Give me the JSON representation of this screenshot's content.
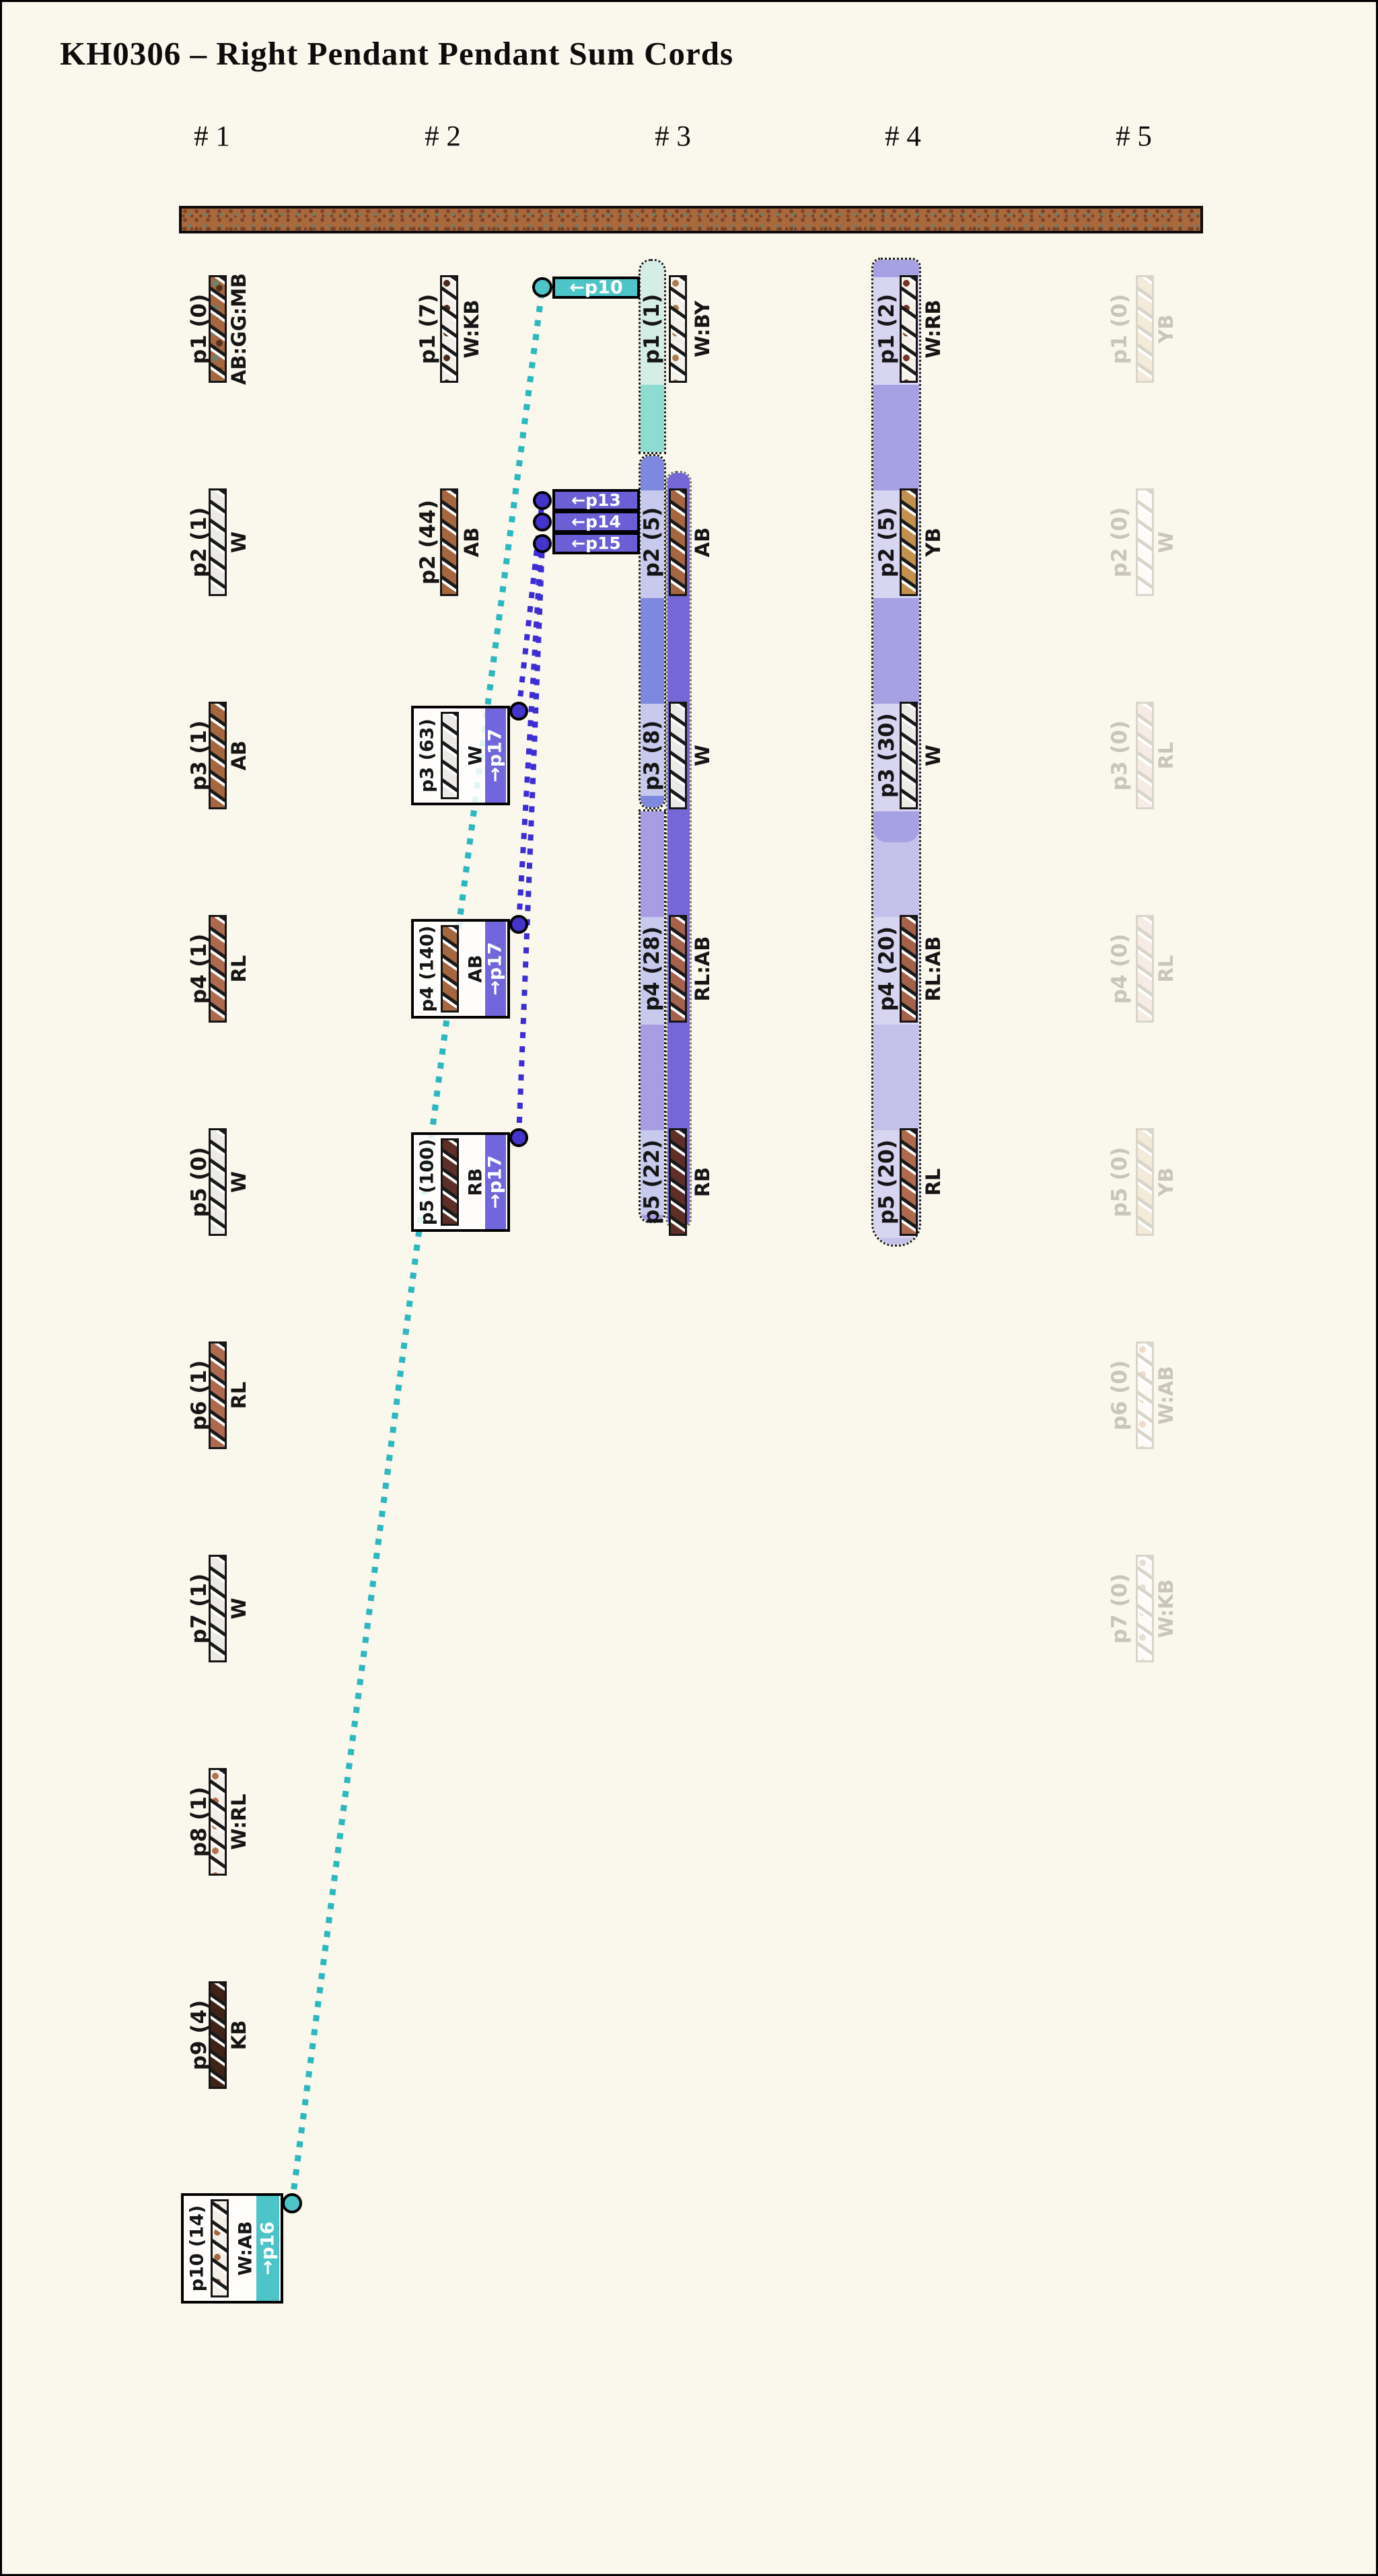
{
  "title": "KH0306 – Right Pendant Pendant Sum Cords",
  "palette": {
    "background": "#faf7ec",
    "ink": "#151515",
    "primary_cord": "#a9693d",
    "primary_speckle_dark": "#7a462c",
    "primary_speckle_green": "#6d7d6d",
    "teal": "#4cc4c8",
    "teal_line": "#2cb8bf",
    "teal_pale": "#d5ede7",
    "teal_bright": "#8edbd1",
    "purple_band": "#7166dc",
    "purple_box": "#6b5fd6",
    "purple_dot": "#4334cb",
    "purple_line": "#3c2ed4",
    "lavender": "#c7c9ed",
    "med_blue": "#7d88de",
    "light_purple": "#a89ce3",
    "dark_purple": "#7567d6",
    "col4_med": "#a6a1e3",
    "col4_light": "#c6c1ea",
    "col4_lavender": "#d8d5f0",
    "faded_text": "#c9c5b8",
    "faded_border": "#d9d5c9"
  },
  "cord_styles": {
    "AB:GG:MB": {
      "base": "#a5673f",
      "speckles": [
        "#6f7f6a",
        "#53301d"
      ]
    },
    "W": {
      "base": "#eceae6",
      "speckles": []
    },
    "AB": {
      "base": "#a5673f",
      "speckles": []
    },
    "RL": {
      "base": "#ae6a4f",
      "speckles": []
    },
    "W:RL": {
      "base": "#f3f0ea",
      "speckles": [
        "#b5704f"
      ]
    },
    "KB": {
      "base": "#402317",
      "speckles": []
    },
    "W:AB": {
      "base": "#f3f0ea",
      "speckles": [
        "#a5673f"
      ]
    },
    "W:KB": {
      "base": "#f3f0ea",
      "speckles": [
        "#4a2a1a"
      ]
    },
    "RB": {
      "base": "#5e2f26",
      "speckles": []
    },
    "W:BY": {
      "base": "#f4f1ea",
      "speckles": [
        "#a97b4e"
      ]
    },
    "RL:AB": {
      "base": "#a5624a",
      "speckles": []
    },
    "YB": {
      "base": "#c2914f",
      "speckles": []
    },
    "W:RB": {
      "base": "#f4f1ea",
      "speckles": [
        "#743327"
      ]
    }
  },
  "cord_styles_faded": {
    "YB": {
      "base": "#f4ead9",
      "speckles": []
    },
    "W": {
      "base": "#fcfbf7",
      "speckles": []
    },
    "RL": {
      "base": "#f6ece5",
      "speckles": []
    },
    "W:AB": {
      "base": "#fcfbf7",
      "speckles": [
        "#eddcca"
      ]
    },
    "W:KB": {
      "base": "#fcfbf7",
      "speckles": [
        "#e7ddd3"
      ]
    }
  },
  "columns": [
    {
      "header": "# 1",
      "pendants": [
        {
          "label": "p1 (0)",
          "code": "AB:GG:MB"
        },
        {
          "label": "p2 (1)",
          "code": "W"
        },
        {
          "label": "p3 (1)",
          "code": "AB"
        },
        {
          "label": "p4 (1)",
          "code": "RL"
        },
        {
          "label": "p5 (0)",
          "code": "W"
        },
        {
          "label": "p6 (1)",
          "code": "RL"
        },
        {
          "label": "p7 (1)",
          "code": "W"
        },
        {
          "label": "p8 (1)",
          "code": "W:RL"
        },
        {
          "label": "p9 (4)",
          "code": "KB"
        },
        {
          "label": "p10 (14)",
          "code": "W:AB",
          "boxed": true,
          "marker": "→p16",
          "accent": "teal"
        }
      ]
    },
    {
      "header": "# 2",
      "pendants": [
        {
          "label": "p1 (7)",
          "code": "W:KB"
        },
        {
          "label": "p2 (44)",
          "code": "AB"
        },
        {
          "label": "p3 (63)",
          "code": "W",
          "boxed": true,
          "marker": "→p17",
          "accent": "purple"
        },
        {
          "label": "p4 (140)",
          "code": "AB",
          "boxed": true,
          "marker": "→p17",
          "accent": "purple"
        },
        {
          "label": "p5 (100)",
          "code": "RB",
          "boxed": true,
          "marker": "→p17",
          "accent": "purple"
        }
      ]
    },
    {
      "header": "# 3",
      "pendants": [
        {
          "label": "p1 (1)",
          "code": "W:BY"
        },
        {
          "label": "p2 (5)",
          "code": "AB"
        },
        {
          "label": "p3 (8)",
          "code": "W"
        },
        {
          "label": "p4 (28)",
          "code": "RL:AB"
        },
        {
          "label": "p5 (22)",
          "code": "RB"
        }
      ]
    },
    {
      "header": "# 4",
      "pendants": [
        {
          "label": "p1 (2)",
          "code": "W:RB"
        },
        {
          "label": "p2 (5)",
          "code": "YB"
        },
        {
          "label": "p3 (30)",
          "code": "W"
        },
        {
          "label": "p4 (20)",
          "code": "RL:AB"
        },
        {
          "label": "p5 (20)",
          "code": "RL"
        }
      ]
    },
    {
      "header": "# 5",
      "faded": true,
      "pendants": [
        {
          "label": "p1 (0)",
          "code": "YB"
        },
        {
          "label": "p2 (0)",
          "code": "W"
        },
        {
          "label": "p3 (0)",
          "code": "RL"
        },
        {
          "label": "p4 (0)",
          "code": "RL"
        },
        {
          "label": "p5 (0)",
          "code": "YB"
        },
        {
          "label": "p6 (0)",
          "code": "W:AB"
        },
        {
          "label": "p7 (0)",
          "code": "W:KB"
        }
      ]
    }
  ],
  "markers": {
    "teal": [
      {
        "label": "←p10"
      }
    ],
    "purple": [
      {
        "label": "←p13"
      },
      {
        "label": "←p14"
      },
      {
        "label": "←p15"
      }
    ]
  },
  "links": [
    {
      "from": "col1-p10",
      "to": "marker-p10",
      "color": "teal"
    },
    {
      "from": "col2-p3",
      "to": "marker-p13",
      "color": "purple"
    },
    {
      "from": "col2-p4",
      "to": "marker-p14",
      "color": "purple"
    },
    {
      "from": "col2-p5",
      "to": "marker-p15",
      "color": "purple"
    }
  ]
}
